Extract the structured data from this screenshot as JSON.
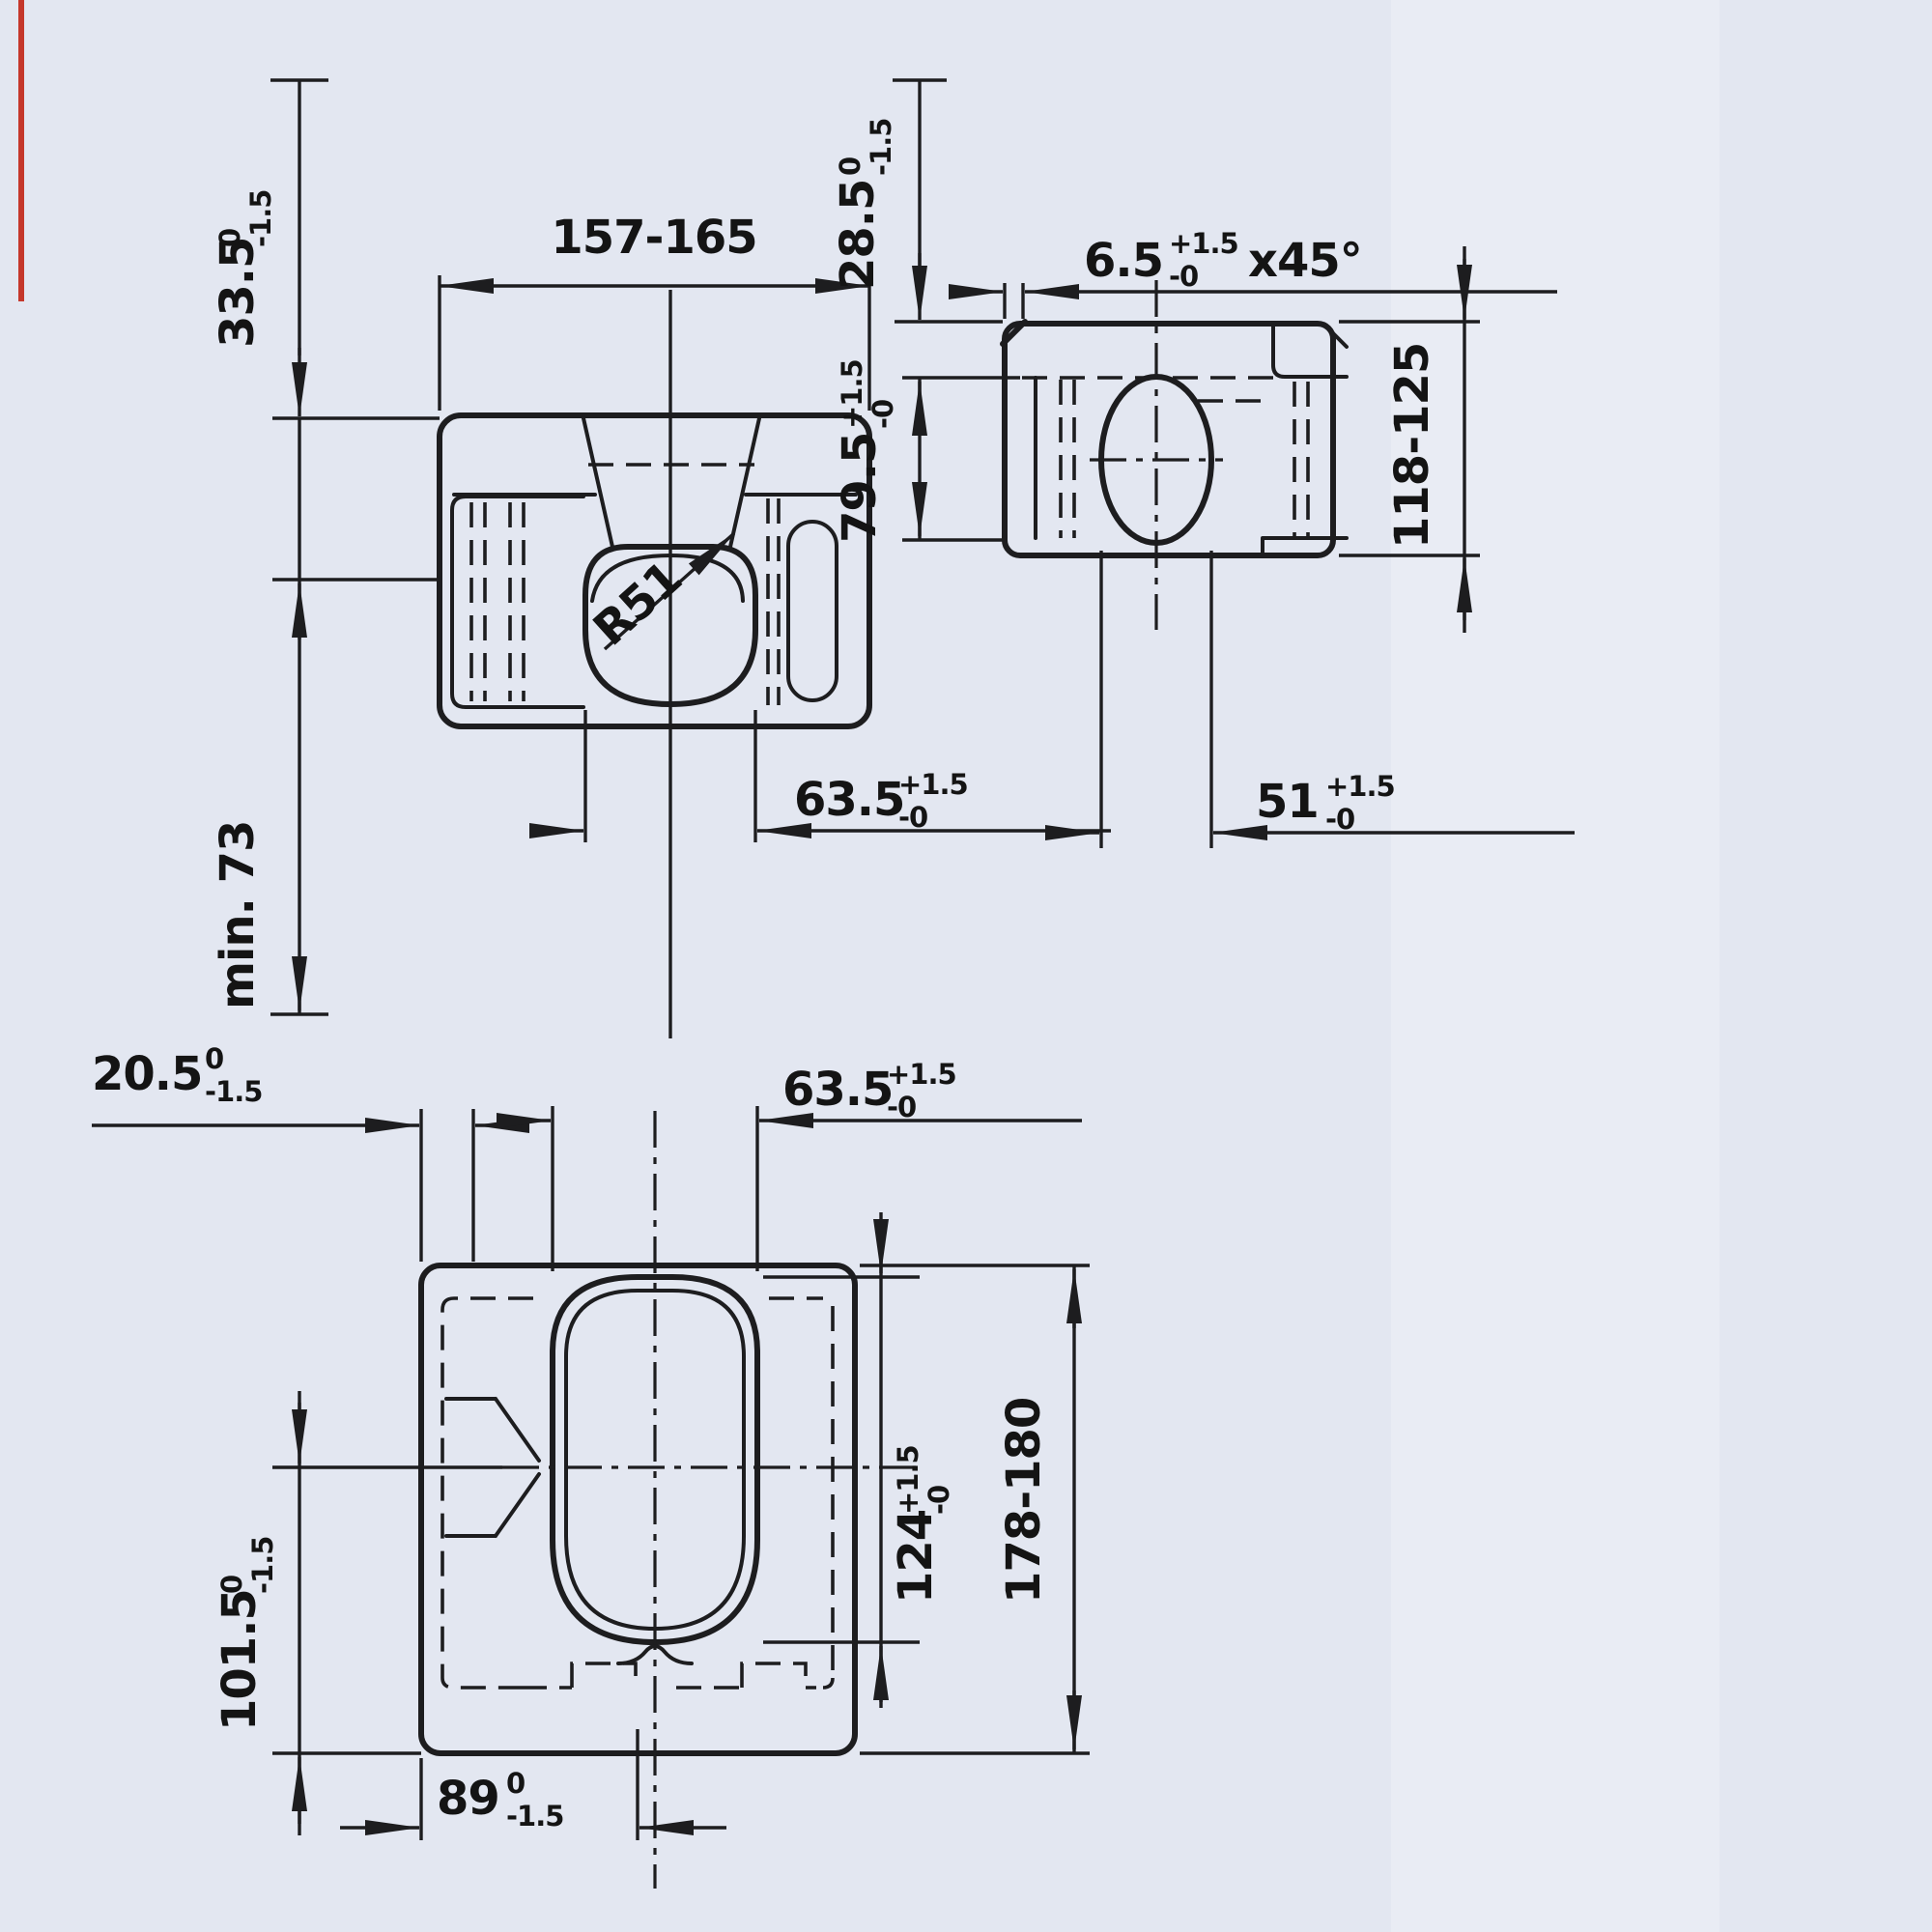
{
  "meta": {
    "drawing_type": "technical three-view drawing, ISO container corner casting",
    "background": "#e3e7f1",
    "line_color": "#1d1d1f",
    "scan_artifact_red": "#c5372b"
  },
  "views": {
    "top_view": {
      "label": "top-view",
      "dims": {
        "width": {
          "value": "157-165"
        },
        "edge_offset": {
          "value": "33.5",
          "tol_plus": "0",
          "tol_minus": "-1.5"
        },
        "min_clearance": {
          "value": "min. 73"
        },
        "aperture_width": {
          "value": "63.5",
          "tol_plus": "+1.5",
          "tol_minus": "-0"
        },
        "radius": {
          "value": "R51"
        }
      }
    },
    "side_view": {
      "label": "side-view",
      "dims": {
        "edge_offset": {
          "value": "28.5",
          "tol_plus": "0",
          "tol_minus": "-1.5"
        },
        "chamfer": {
          "value": "6.5",
          "tol_plus": "+1.5",
          "tol_minus": "-0",
          "suffix": "x45°"
        },
        "aperture_offset": {
          "value": "79.5",
          "tol_plus": "+1.5",
          "tol_minus": "-0"
        },
        "height": {
          "value": "118-125"
        },
        "aperture_width": {
          "value": "51",
          "tol_plus": "+1.5",
          "tol_minus": "-0"
        }
      }
    },
    "front_view": {
      "label": "front-bottom-view",
      "dims": {
        "edge_offset": {
          "value": "20.5",
          "tol_plus": "0",
          "tol_minus": "-1.5"
        },
        "aperture_width": {
          "value": "63.5",
          "tol_plus": "+1.5",
          "tol_minus": "-0"
        },
        "vertical_offset": {
          "value": "101.5",
          "tol_plus": "0",
          "tol_minus": "-1.5"
        },
        "aperture_height": {
          "value": "124",
          "tol_plus": "+1.5",
          "tol_minus": "-0"
        },
        "height": {
          "value": "178-180"
        },
        "base_offset": {
          "value": "89",
          "tol_plus": "0",
          "tol_minus": "-1.5"
        }
      }
    }
  }
}
